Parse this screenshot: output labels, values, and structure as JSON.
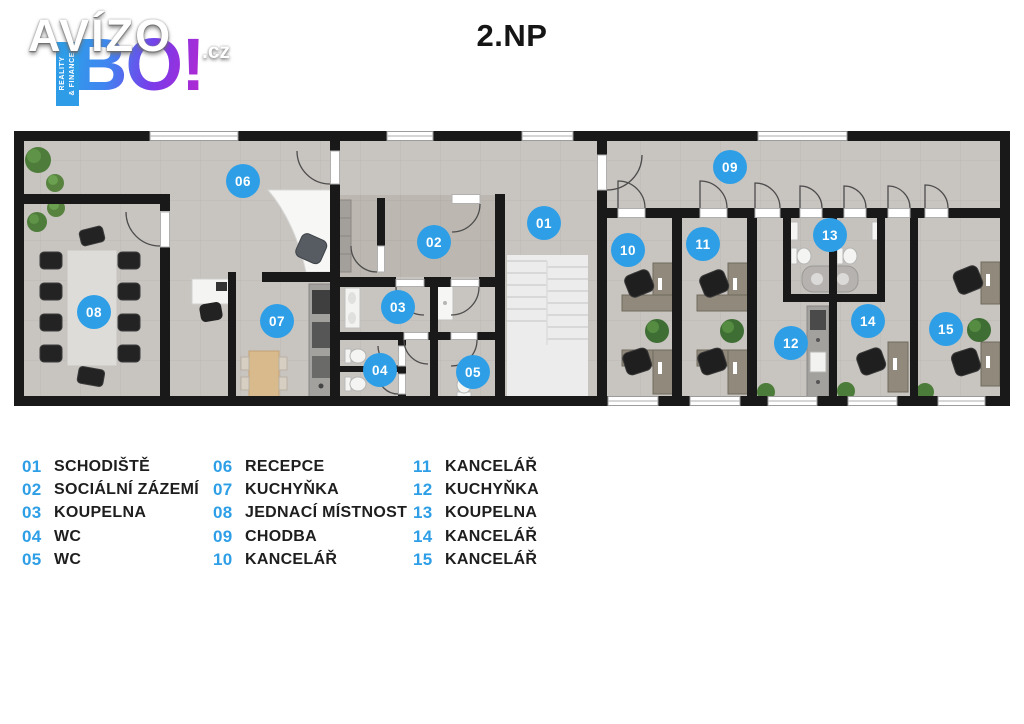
{
  "page": {
    "title": "2.NP"
  },
  "logo": {
    "brand": "AVÍZO",
    "tld": ".cz",
    "sub_brand": "BO!",
    "ribbon_text": "REALITY\n& FINANCE"
  },
  "colors": {
    "accent_blue": "#2e9fe6",
    "wall": "#191919",
    "floor": "#c8c4c0",
    "floor_dark": "#bcb7b0",
    "stairs": "#ececec",
    "legend_text": "#1e1e1e"
  },
  "floor_plan": {
    "markers": [
      {
        "id": "01",
        "x": 544,
        "y": 223
      },
      {
        "id": "02",
        "x": 434,
        "y": 242
      },
      {
        "id": "03",
        "x": 398,
        "y": 307
      },
      {
        "id": "04",
        "x": 380,
        "y": 370
      },
      {
        "id": "05",
        "x": 473,
        "y": 372
      },
      {
        "id": "06",
        "x": 243,
        "y": 181
      },
      {
        "id": "07",
        "x": 277,
        "y": 321
      },
      {
        "id": "08",
        "x": 94,
        "y": 312
      },
      {
        "id": "09",
        "x": 730,
        "y": 167
      },
      {
        "id": "10",
        "x": 628,
        "y": 250
      },
      {
        "id": "11",
        "x": 703,
        "y": 244
      },
      {
        "id": "12",
        "x": 791,
        "y": 343
      },
      {
        "id": "13",
        "x": 830,
        "y": 235
      },
      {
        "id": "14",
        "x": 868,
        "y": 321
      },
      {
        "id": "15",
        "x": 946,
        "y": 329
      }
    ]
  },
  "legend": {
    "columns": [
      {
        "x": 22,
        "items": [
          {
            "num": "01",
            "label": "SCHODIŠTĚ"
          },
          {
            "num": "02",
            "label": "SOCIÁLNÍ ZÁZEMÍ"
          },
          {
            "num": "03",
            "label": "KOUPELNA"
          },
          {
            "num": "04",
            "label": "WC"
          },
          {
            "num": "05",
            "label": "WC"
          }
        ]
      },
      {
        "x": 213,
        "items": [
          {
            "num": "06",
            "label": "RECEPCE"
          },
          {
            "num": "07",
            "label": "KUCHYŇKA"
          },
          {
            "num": "08",
            "label": "JEDNACÍ MÍSTNOST"
          },
          {
            "num": "09",
            "label": "CHODBA"
          },
          {
            "num": "10",
            "label": "KANCELÁŘ"
          }
        ]
      },
      {
        "x": 413,
        "items": [
          {
            "num": "11",
            "label": "KANCELÁŘ"
          },
          {
            "num": "12",
            "label": "KUCHYŇKA"
          },
          {
            "num": "13",
            "label": "KOUPELNA"
          },
          {
            "num": "14",
            "label": "KANCELÁŘ"
          },
          {
            "num": "15",
            "label": "KANCELÁŘ"
          }
        ]
      }
    ]
  }
}
